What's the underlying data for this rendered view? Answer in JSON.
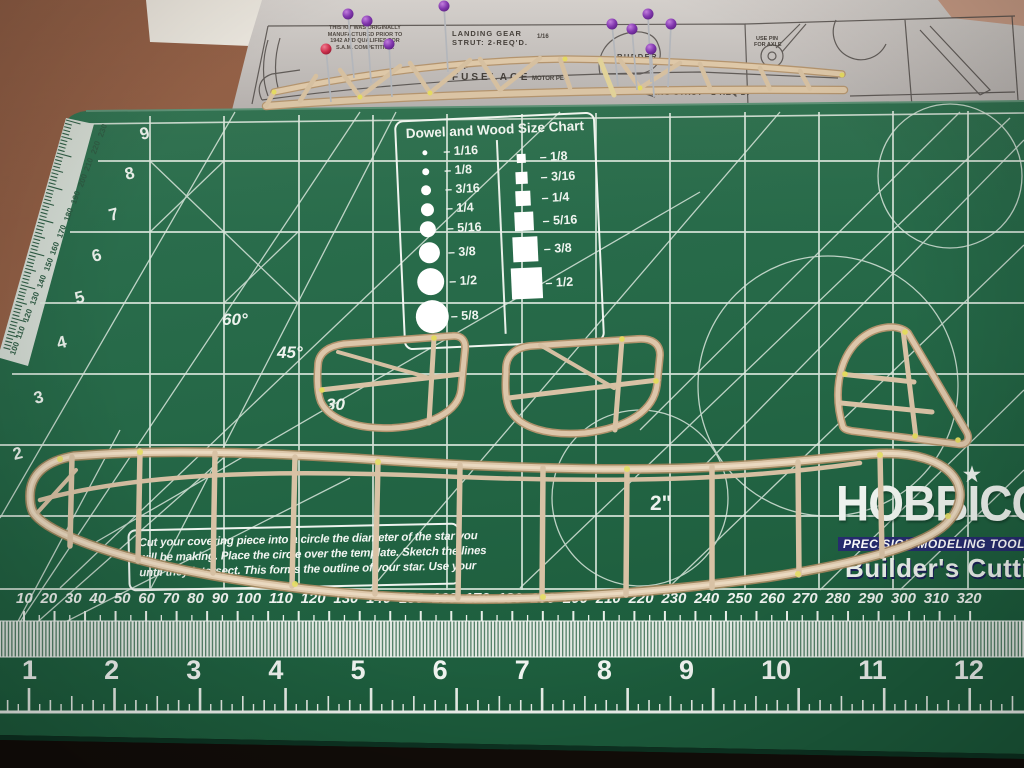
{
  "plan": {
    "kit_note_lines": [
      "THIS KIT WAS ORIGINALLY",
      "MANUFACTURED PRIOR TO",
      "1942 AND QUALIFIES FOR",
      "S.A.M. COMPETITION."
    ],
    "labels": {
      "landing_gear_1": "LANDING GEAR",
      "landing_gear_2": "STRUT: 2-REQ'D.",
      "size_note_1": "1/16",
      "size_note_2": "1/16 SQ.",
      "fuselage": "FUSELAGE",
      "motor_peg": "MOTOR PEG",
      "rudder": "RUDDER",
      "wing_strut": "WING STRUT - 2-REQ'D.",
      "axle_1": "USE PIN",
      "axle_2": "FOR AXLE"
    }
  },
  "mat": {
    "size_chart": {
      "title": "Dowel and Wood Size Chart",
      "dowel_sizes": [
        "1/16",
        "1/8",
        "3/16",
        "1/4",
        "5/16",
        "3/8",
        "1/2",
        "5/8"
      ],
      "wood_sizes": [
        "1/8",
        "3/16",
        "1/4",
        "5/16",
        "3/8",
        "1/2"
      ]
    },
    "instructions_lines": [
      "Cut your covering piece into a circle the diameter of the star you",
      "will be making. Place the circle over the template. Sketch the lines",
      "until they intersect. This forms the outline of your star. Use your"
    ],
    "angle_labels": {
      "a60": "60°",
      "a45": "45°",
      "a30": "30"
    },
    "two_inch_label": "2\"",
    "brand": {
      "name": "HOBBICO",
      "star": "★",
      "tagline": "PRECISION MODELING TOOLS",
      "product_line": "Builder's Cutting"
    },
    "rulers": {
      "bottom_mm": [
        10,
        20,
        30,
        40,
        50,
        60,
        70,
        80,
        90,
        100,
        110,
        120,
        130,
        140,
        150,
        160,
        170,
        180,
        190,
        200,
        210,
        220,
        230,
        240,
        250,
        260,
        270,
        280,
        290,
        300,
        310,
        320
      ],
      "bottom_inch": [
        1,
        2,
        3,
        4,
        5,
        6,
        7,
        8,
        9,
        10,
        11,
        12
      ],
      "left_inch": [
        9,
        8,
        7,
        6,
        5,
        4,
        3,
        2
      ],
      "left_mm": [
        230,
        220,
        210,
        200,
        190,
        180,
        170,
        160,
        150,
        140,
        130,
        120,
        110,
        100
      ]
    },
    "colors": {
      "mat_green": "#256847",
      "grid_white": "#dde8de",
      "balsa_tan": "#dcc5a8",
      "glue_yellow": "#e6df66",
      "pin_purple": "#7b2fae",
      "pin_red": "#cc2a4a",
      "logo_navy": "#262c6f"
    }
  }
}
